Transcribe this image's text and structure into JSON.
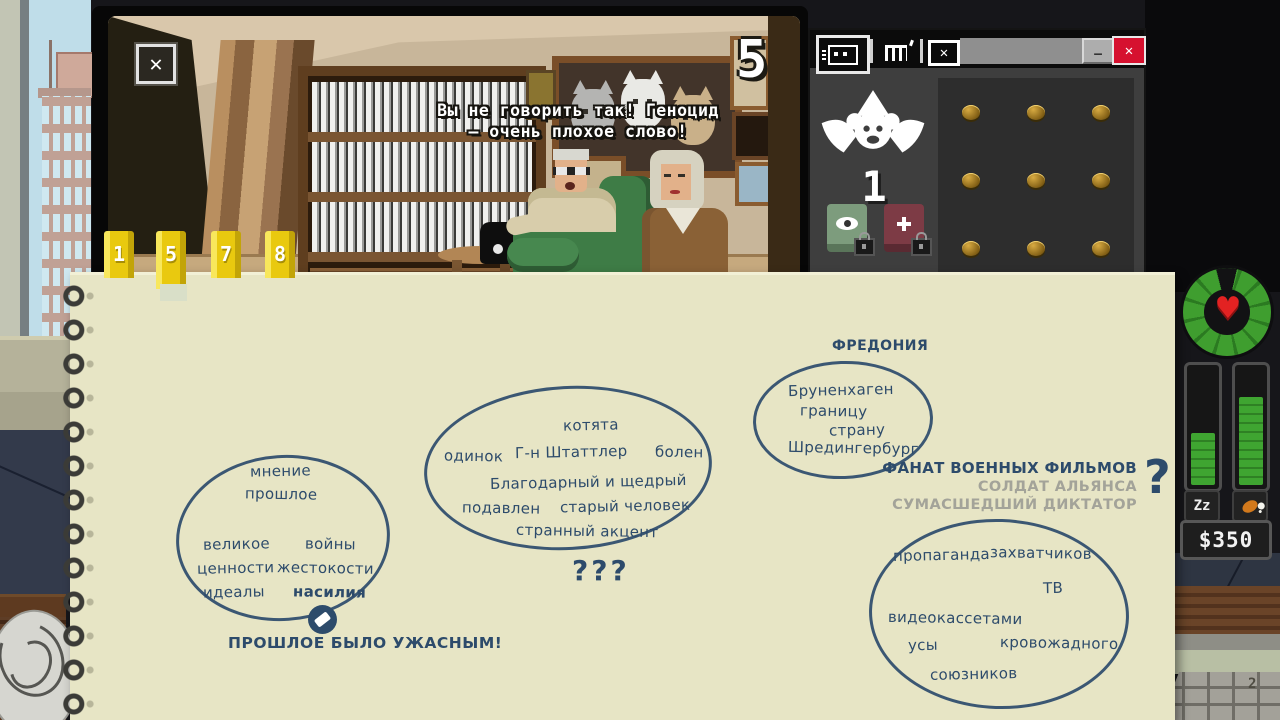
{
  "monitor": {
    "close_glyph": "✕",
    "camera_number": "5",
    "dialogue": [
      "Вы не говорить так! Геноцид",
      "— очень плохое слово!"
    ]
  },
  "camera_tabs": [
    {
      "label": "1"
    },
    {
      "label": "5"
    },
    {
      "label": "7"
    },
    {
      "label": "8"
    }
  ],
  "inventory_window": {
    "tab_icons": [
      "cassette-tab-icon",
      "cage-tab-icon",
      "blocked-tab-icon"
    ],
    "minimize_glyph": "—",
    "close_glyph": "✕",
    "monkey_counter": "1",
    "coins": [
      "coin",
      "coin",
      "coin",
      "coin",
      "coin",
      "coin",
      "coin",
      "coin",
      "coin"
    ]
  },
  "notebook": {
    "clusters": [
      {
        "words": [
          "мнение",
          "прошлое",
          "великое",
          "войны",
          "ценности",
          "жестокости",
          "идеалы",
          "насилия"
        ],
        "conclusion": "ПРОШЛОЕ БЫЛО УЖАСНЫМ!"
      },
      {
        "words": [
          "котята",
          "одинок",
          "Г-н Штаттлер",
          "болен",
          "Благодарный и щедрый",
          "подавлен",
          "старый человек",
          "странный акцент"
        ],
        "conclusion": "???"
      },
      {
        "label": "ФРЕДОНИЯ",
        "words": [
          "Бруненхаген",
          "границу",
          "страну",
          "Шредингербург"
        ]
      },
      {
        "words": [
          "пропаганда",
          "захватчиков",
          "ТВ",
          "видеокассетами",
          "усы",
          "кровожадного",
          "союзников"
        ]
      }
    ],
    "guesses": {
      "primary": "ФАНАТ ВОЕННЫХ ФИЛЬМОВ",
      "alternatives": [
        "СОЛДАТ АЛЬЯНСА",
        "СУМАСШЕДШИЙ ДИКТАТОР"
      ],
      "question_glyph": "?"
    }
  },
  "hud": {
    "money": "$350",
    "sleep_glyph": "Zz"
  },
  "desk": {
    "keyboard_key": "2"
  },
  "colors": {
    "ink": "#2d4b6b",
    "paper": "#e7e5c5",
    "tab_yellow": "#e9c90f",
    "hud_green": "#3f9e2f",
    "heart_red": "#e32222",
    "close_red": "#d6112f",
    "guess_gray": "#a3a399"
  }
}
